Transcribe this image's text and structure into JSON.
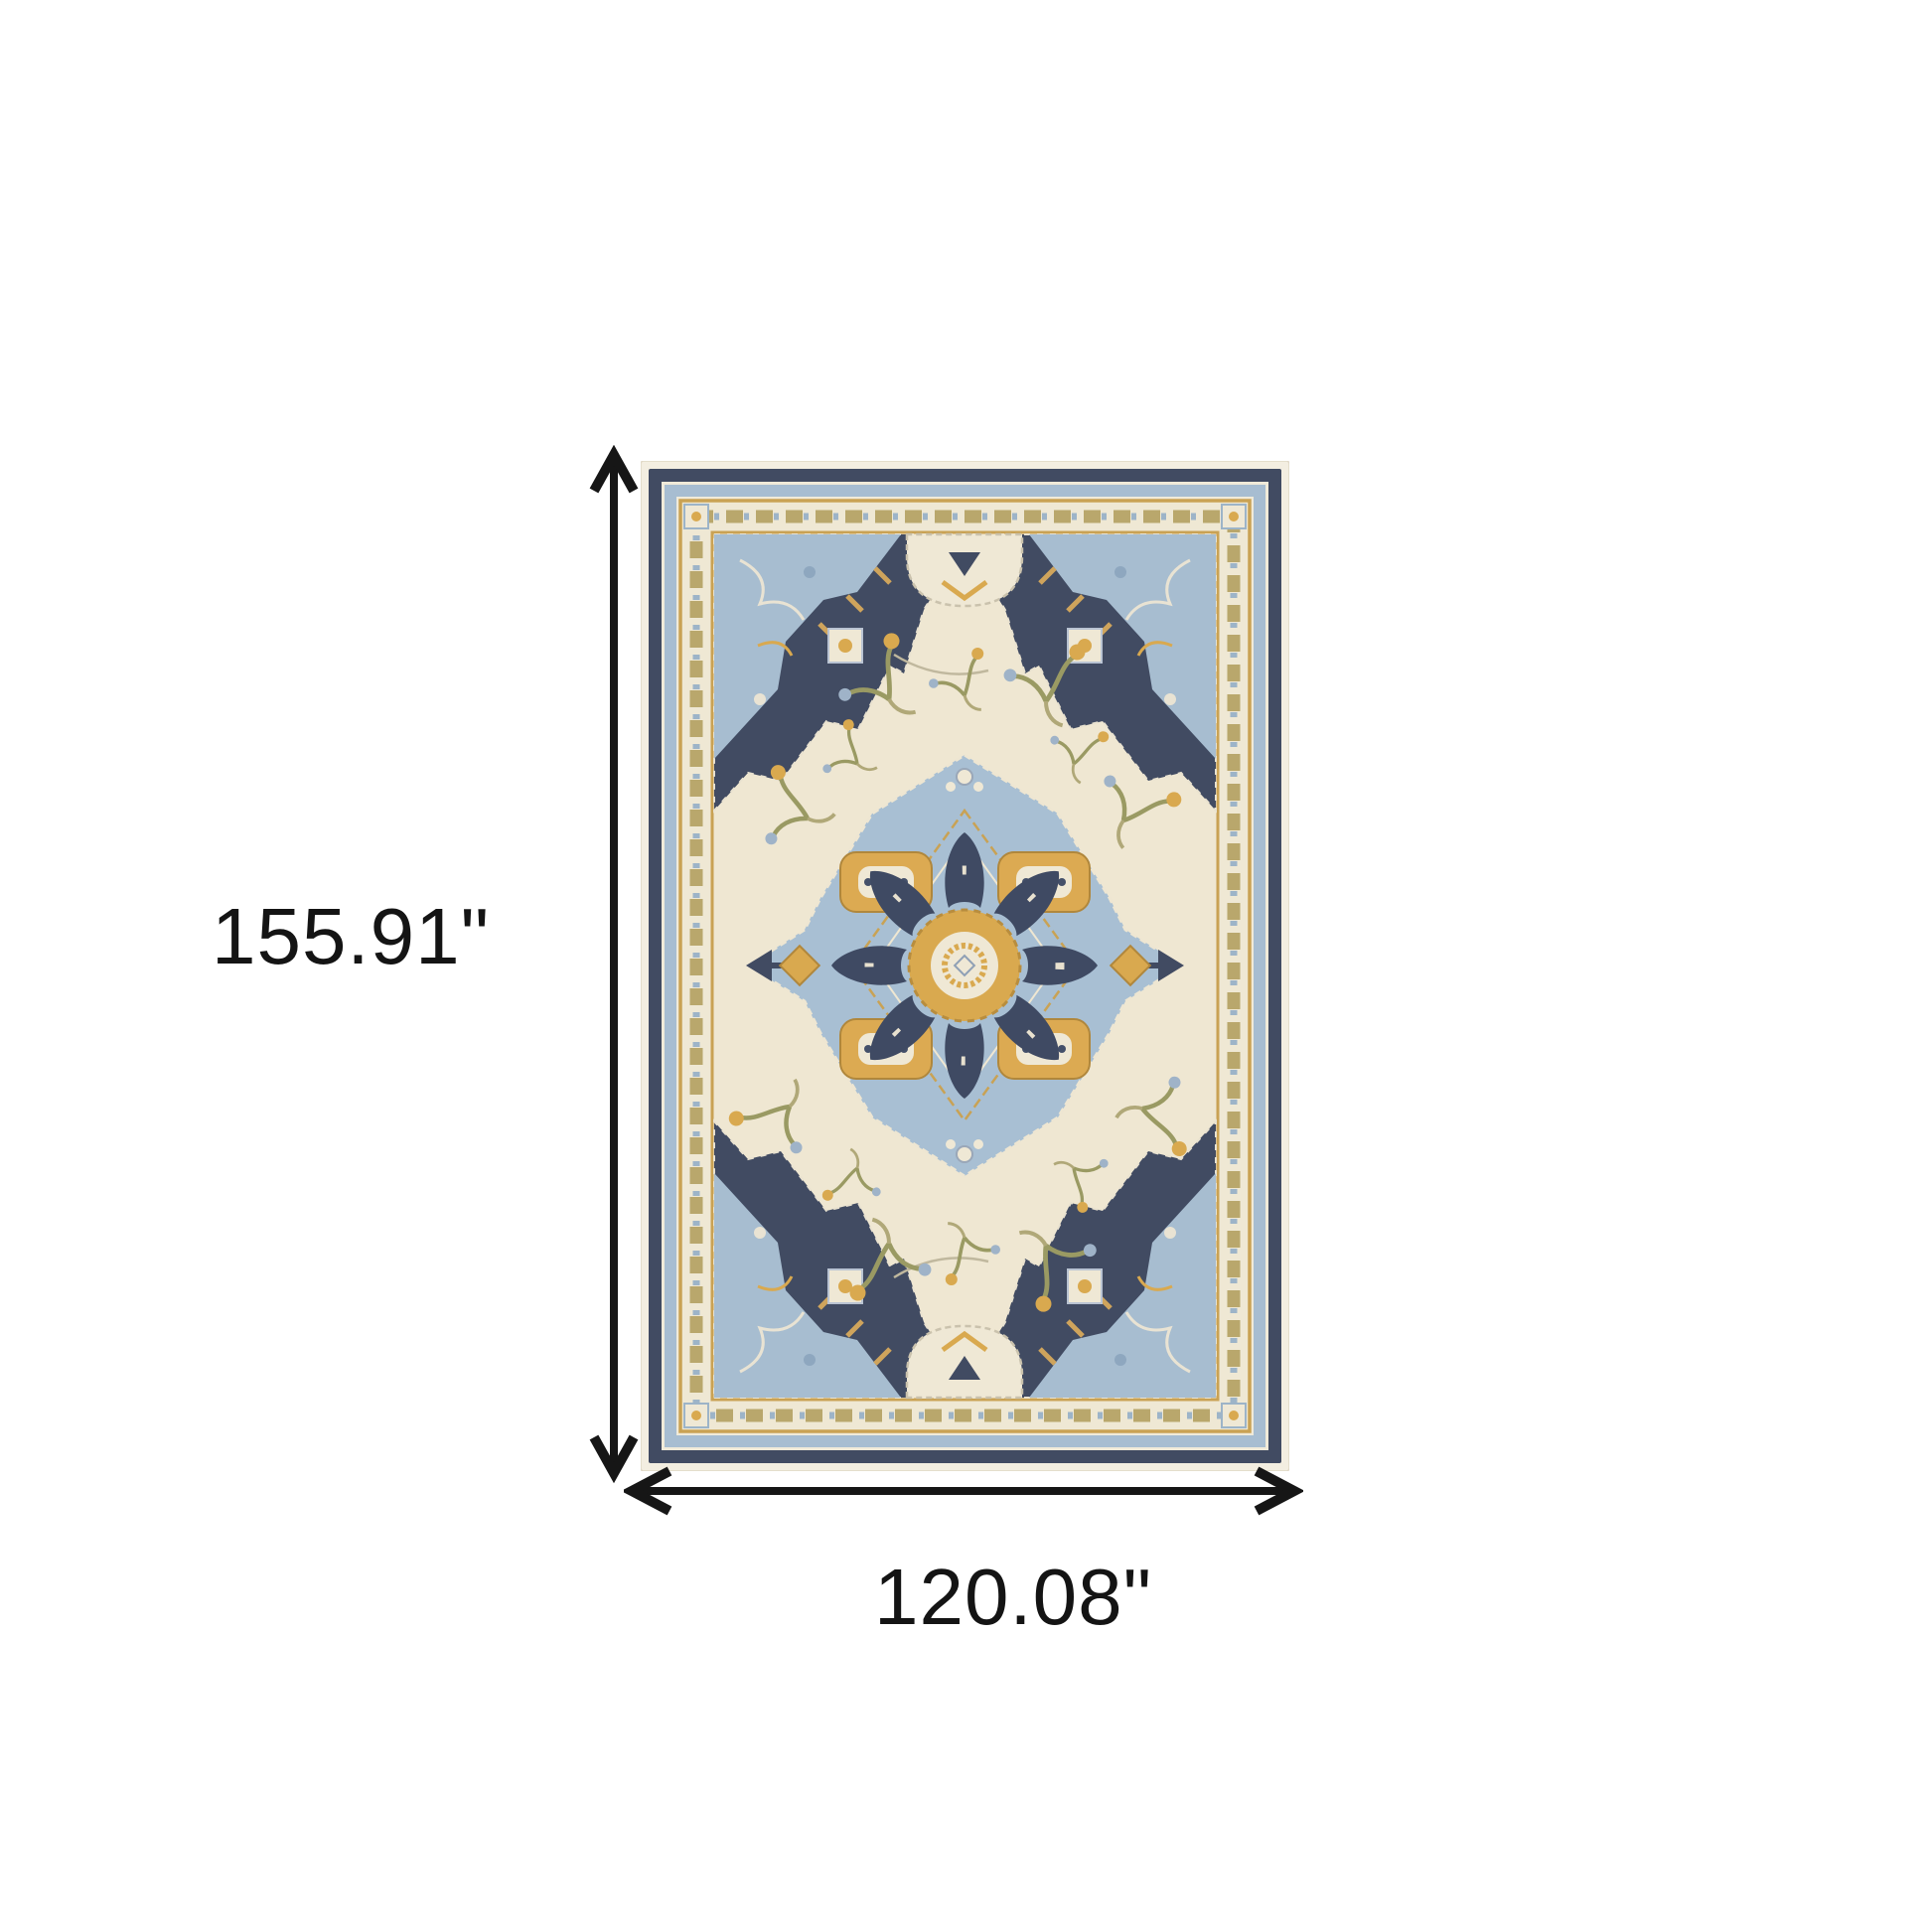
{
  "diagram": {
    "height_label": "155.91\"",
    "width_label": "120.08\"",
    "arrow_color": "#161616",
    "text_color": "#141414",
    "background": "#ffffff"
  },
  "rug": {
    "palette": {
      "ivory_edge": "#f3eee1",
      "field_cream": "#efe7d2",
      "band_cream": "#efe8d4",
      "navy": "#414b62",
      "light_blue": "#a7bdd1",
      "medallion_blue": "#a8bfd3",
      "gold": "#d9a94f",
      "deep_gold": "#c9a254",
      "olive": "#9a9a63",
      "gray_blue": "#8fa6bd"
    }
  }
}
